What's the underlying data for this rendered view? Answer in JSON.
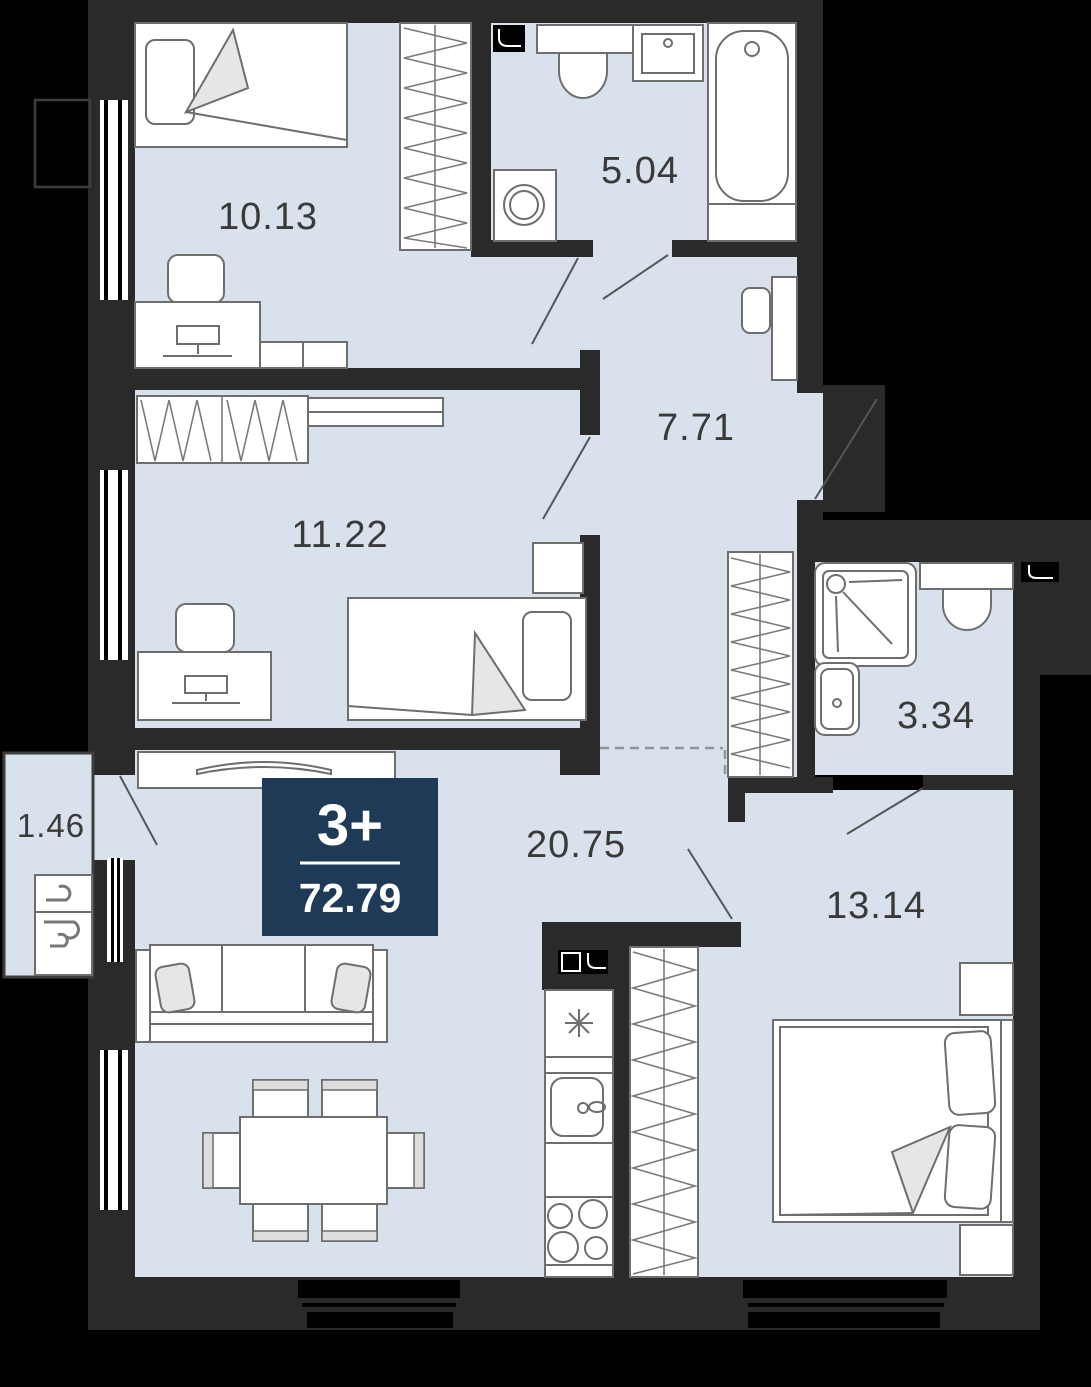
{
  "title": "Apartment floor plan",
  "badge": {
    "rooms": "3+",
    "area": "72.79",
    "bg_color": "#1f3a57",
    "text_color": "#ffffff"
  },
  "rooms": [
    {
      "name": "bedroom-top",
      "area": "10.13"
    },
    {
      "name": "bathroom-main",
      "area": "5.04"
    },
    {
      "name": "hallway",
      "area": "7.71"
    },
    {
      "name": "bedroom-middle",
      "area": "11.22"
    },
    {
      "name": "bathroom-ensuite",
      "area": "3.34"
    },
    {
      "name": "balcony",
      "area": "1.46"
    },
    {
      "name": "living-kitchen",
      "area": "20.75"
    },
    {
      "name": "bedroom-master",
      "area": "13.14"
    }
  ],
  "colors": {
    "background": "#000000",
    "wall": "#2a2a2b",
    "floor": "#d8e1ec",
    "furniture_outline": "#6e6e6e",
    "label_text": "#3a3a3a",
    "badge_bg": "#1f3a57"
  },
  "icons": [
    "vent-shaft-icon",
    "washing-machine-icon",
    "shower-icon",
    "toilet-icon",
    "bathtub-icon",
    "sink-icon",
    "fridge-snowflake-icon",
    "stove-burners-icon",
    "air-conditioner-breeze-icon",
    "tv-icon",
    "window-icon",
    "door-swing-icon"
  ]
}
